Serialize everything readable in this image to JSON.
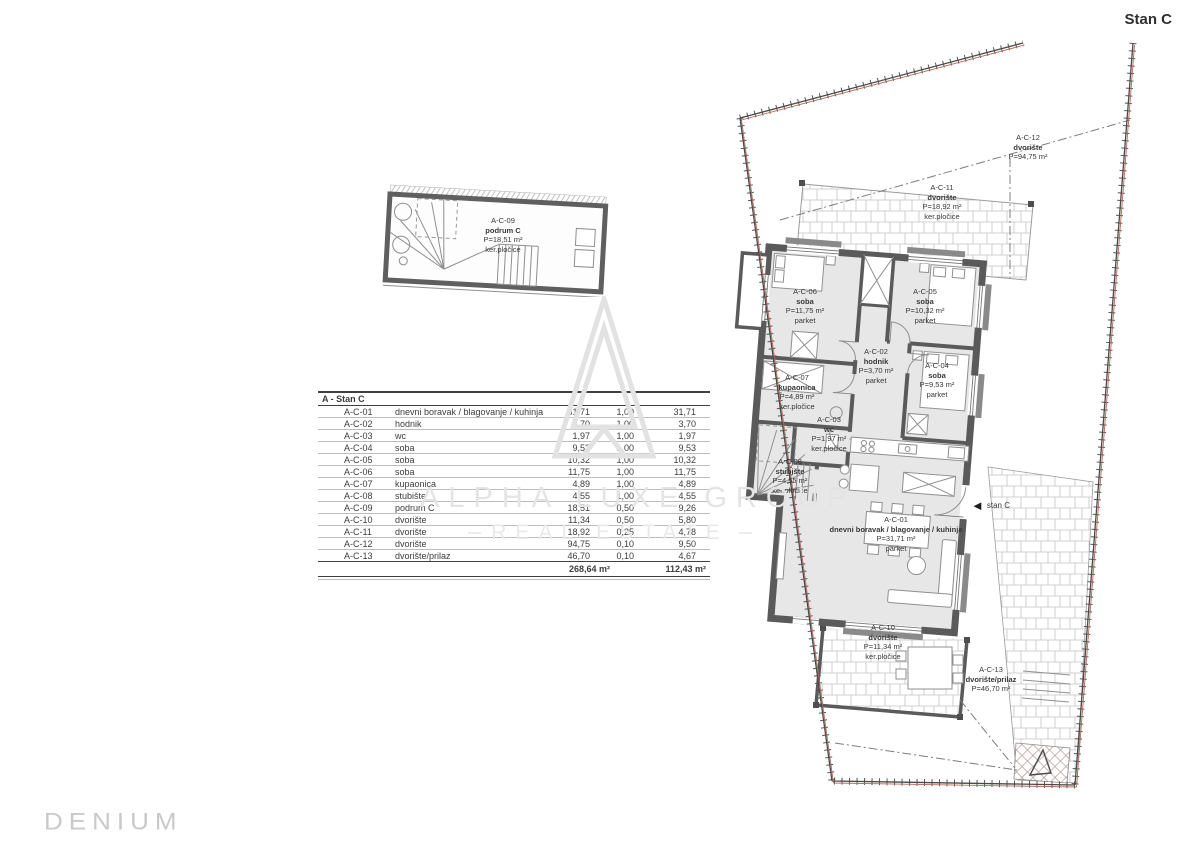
{
  "header": {
    "plan_title": "Stan C"
  },
  "branding": {
    "logo_text": "DENIUM"
  },
  "watermark": {
    "line1": "ALPHA LUXE GROUP",
    "line2": "REAL ESTATE"
  },
  "colors": {
    "wall": "#5a5a5a",
    "room_fill": "#e7e7e7",
    "boundary_red": "#b26a5a",
    "watermark_gray": "#e4e4e4"
  },
  "area_table": {
    "title": "A - Stan C",
    "rows": [
      {
        "code": "A-C-01",
        "name": "dnevni boravak / blagovanje / kuhinja",
        "area": "31,71",
        "coef": "1,00",
        "result": "31,71"
      },
      {
        "code": "A-C-02",
        "name": "hodnik",
        "area": "3,70",
        "coef": "1,00",
        "result": "3,70"
      },
      {
        "code": "A-C-03",
        "name": "wc",
        "area": "1,97",
        "coef": "1,00",
        "result": "1,97"
      },
      {
        "code": "A-C-04",
        "name": "soba",
        "area": "9,53",
        "coef": "1,00",
        "result": "9,53"
      },
      {
        "code": "A-C-05",
        "name": "soba",
        "area": "10,32",
        "coef": "1,00",
        "result": "10,32"
      },
      {
        "code": "A-C-06",
        "name": "soba",
        "area": "11,75",
        "coef": "1,00",
        "result": "11,75"
      },
      {
        "code": "A-C-07",
        "name": "kupaonica",
        "area": "4,89",
        "coef": "1,00",
        "result": "4,89"
      },
      {
        "code": "A-C-08",
        "name": "stubište",
        "area": "4,55",
        "coef": "1,00",
        "result": "4,55"
      },
      {
        "code": "A-C-09",
        "name": "podrum C",
        "area": "18,51",
        "coef": "0,50",
        "result": "9,26"
      },
      {
        "code": "A-C-10",
        "name": "dvorište",
        "area": "11,34",
        "coef": "0,50",
        "result": "5,80"
      },
      {
        "code": "A-C-11",
        "name": "dvorište",
        "area": "18,92",
        "coef": "0,25",
        "result": "4,78"
      },
      {
        "code": "A-C-12",
        "name": "dvorište",
        "area": "94,75",
        "coef": "0,10",
        "result": "9,50"
      },
      {
        "code": "A-C-13",
        "name": "dvorište/prilaz",
        "area": "46,70",
        "coef": "0,10",
        "result": "4,67"
      }
    ],
    "total_area": "268,64 m²",
    "total_result": "112,43 m²"
  },
  "basement_plan": {
    "label": {
      "code": "A-C-09",
      "name": "podrum C",
      "area": "P=18,51 m²",
      "floor": "ker.pločice"
    }
  },
  "main_plan": {
    "entrance": {
      "label": "stan C"
    },
    "rooms": [
      {
        "id": "A-C-12",
        "name": "dvorište",
        "area": "P=94,75 m²",
        "floor": "",
        "x": 303,
        "y": 98
      },
      {
        "id": "A-C-11",
        "name": "dvorište",
        "area": "P=18,92 m²",
        "floor": "ker.pločice",
        "x": 217,
        "y": 148
      },
      {
        "id": "A-C-06",
        "name": "soba",
        "area": "P=11,75 m²",
        "floor": "parket",
        "x": 80,
        "y": 252
      },
      {
        "id": "A-C-05",
        "name": "soba",
        "area": "P=10,32 m²",
        "floor": "parket",
        "x": 200,
        "y": 252
      },
      {
        "id": "A-C-02",
        "name": "hodnik",
        "area": "P=3,70 m²",
        "floor": "parket",
        "x": 151,
        "y": 312
      },
      {
        "id": "A-C-04",
        "name": "soba",
        "area": "P=9,53 m²",
        "floor": "parket",
        "x": 212,
        "y": 326
      },
      {
        "id": "A-C-07",
        "name": "kupaonica",
        "area": "P=4,89 m²",
        "floor": "ker.pločice",
        "x": 72,
        "y": 338
      },
      {
        "id": "A-C-03",
        "name": "wc",
        "area": "P=1,97 m²",
        "floor": "ker.pločice",
        "x": 104,
        "y": 380
      },
      {
        "id": "A-C-08",
        "name": "stubište",
        "area": "P=4,55 m²",
        "floor": "ker.pločice",
        "x": 65,
        "y": 422
      },
      {
        "id": "A-C-01",
        "name": "dnevni boravak / blagovanje / kuhinja",
        "area": "P=31,71 m²",
        "floor": "parket",
        "x": 171,
        "y": 480
      },
      {
        "id": "A-C-10",
        "name": "dvorište",
        "area": "P=11,34 m²",
        "floor": "ker.pločice",
        "x": 158,
        "y": 588
      },
      {
        "id": "A-C-13",
        "name": "dvorište/prilaz",
        "area": "P=46,70 m²",
        "floor": "",
        "x": 266,
        "y": 630
      }
    ]
  }
}
